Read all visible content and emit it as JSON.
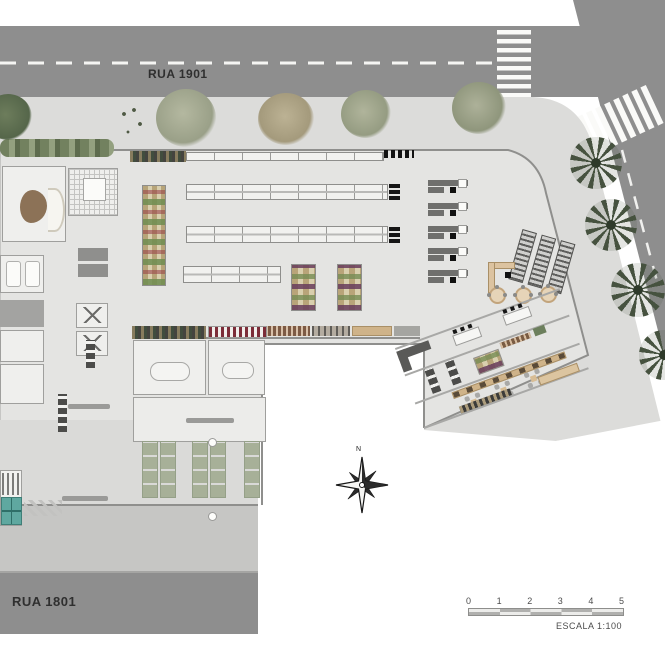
{
  "streets": {
    "top_label": "RUA 1901",
    "bottom_label": "RUA 1801"
  },
  "compass": {
    "north_label": "N"
  },
  "scale_bar": {
    "ticks": [
      "0",
      "1",
      "2",
      "3",
      "4",
      "5"
    ],
    "label": "ESCALA  1:100"
  },
  "colors": {
    "road": "#8e8e8e",
    "sidewalk": "#dcdcda",
    "sidewalk_south": "#c6c6c4",
    "building_floor": "#e4e4e2",
    "parking_stall_green": "#a7b098",
    "tree_green": "#7d8a6d",
    "tree_sage": "#a9ad97",
    "tree_khaki": "#b3a98e",
    "palm_green": "#46523f",
    "produce_purple": "#683c5c",
    "produce_green": "#768c54",
    "wood_counter": "#cfb389",
    "stair_teal": "#5fa8a0",
    "checkout_gray": "#6f6f6d"
  },
  "plan_features": {
    "gondola_rows": 4,
    "checkout_lanes": 5,
    "cart_rack_rows": 3,
    "cafe_round_tables": 3,
    "dining_table_sets": 3,
    "parking_stall_columns": 5,
    "street_trees": 5,
    "palm_trees": 4
  }
}
